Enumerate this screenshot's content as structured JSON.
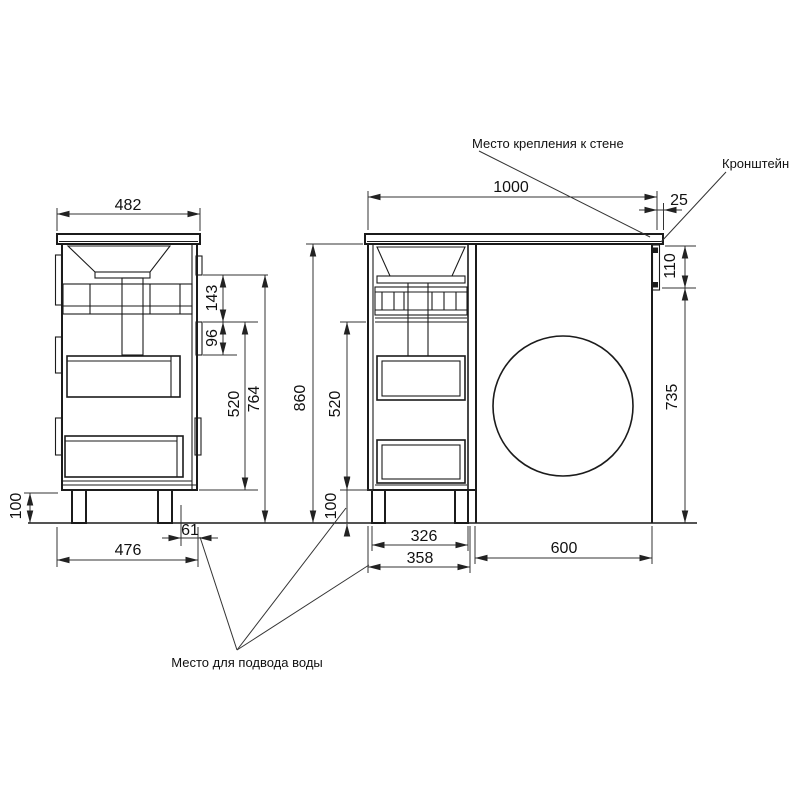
{
  "drawing": {
    "callouts": {
      "wall_mount": "Место крепления к стене",
      "bracket": "Кронштейн",
      "water_supply": "Место для подвода воды"
    },
    "side_view": {
      "counter_depth": "482",
      "rail_offset": "143",
      "rail_height": "96",
      "drawer_section_height": "520",
      "body_height": "764",
      "leg_height": "100",
      "base_depth": "476",
      "back_clearance": "61"
    },
    "front_view": {
      "counter_width": "1000",
      "side_overhang": "25",
      "bracket_height": "110",
      "bracket_to_floor": "735",
      "total_height": "860",
      "drawer_section_height": "520",
      "leg_height": "100",
      "leg_span": "326",
      "cabinet_width": "358",
      "niche_width": "600"
    }
  }
}
